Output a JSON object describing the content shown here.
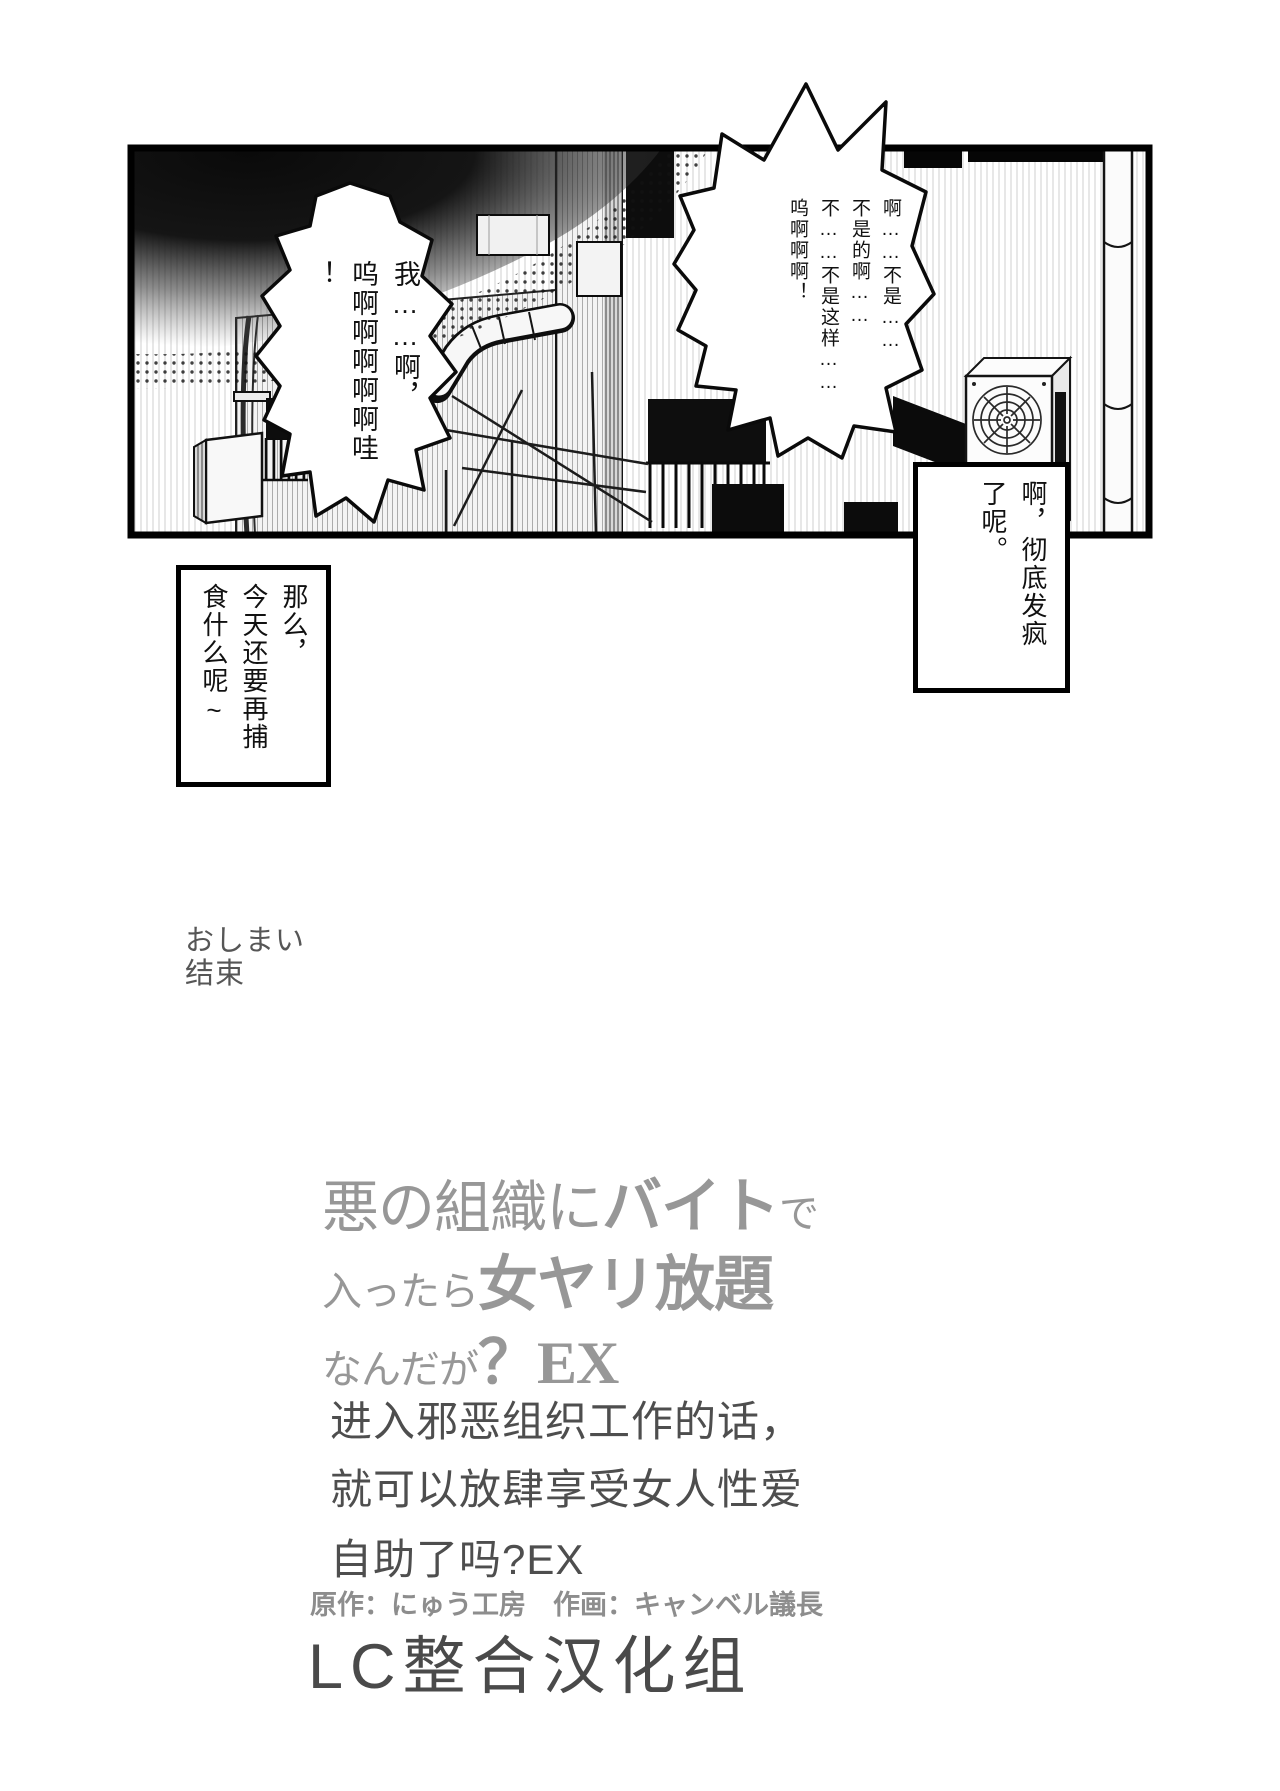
{
  "page": {
    "end_note_jp": "おしまい",
    "end_note_cn": "结束"
  },
  "panel": {
    "bubble_right_text": "啊……不是……\n不是的啊……\n不……不是这样……\n呜啊啊啊！",
    "bubble_left_text": "我……啊，\n呜啊啊啊啊啊哇\n！",
    "caption_right_text": "啊，彻底发疯\n了呢。",
    "caption_left_text": "那么，\n今天还要再捕\n食什么呢~"
  },
  "title": {
    "jp_line1": [
      {
        "t": "悪の組織に",
        "s": "lg"
      },
      {
        "t": "バイト",
        "s": "xl"
      },
      {
        "t": "で",
        "s": "md"
      }
    ],
    "jp_line2": [
      {
        "t": "入ったら",
        "s": "md"
      },
      {
        "t": "女ヤリ放題",
        "s": "xl"
      }
    ],
    "jp_line3": [
      {
        "t": "なんだが",
        "s": "md"
      },
      {
        "t": "？EX",
        "s": "xl"
      }
    ],
    "cn_line1": "进入邪恶组织工作的话，",
    "cn_line2": "就可以放肆享受女人性爱",
    "cn_line3": "自助了吗?EX",
    "credits": "原作：にゅう工房　作画：キャンベル議長",
    "group": "LC整合汉化组"
  },
  "colors": {
    "ink": "#111111",
    "title_jp": "#979797",
    "title_cn": "#4e4e4e",
    "credits": "#8d8d8d",
    "group": "#4a4a4a",
    "end_note": "#565656"
  }
}
